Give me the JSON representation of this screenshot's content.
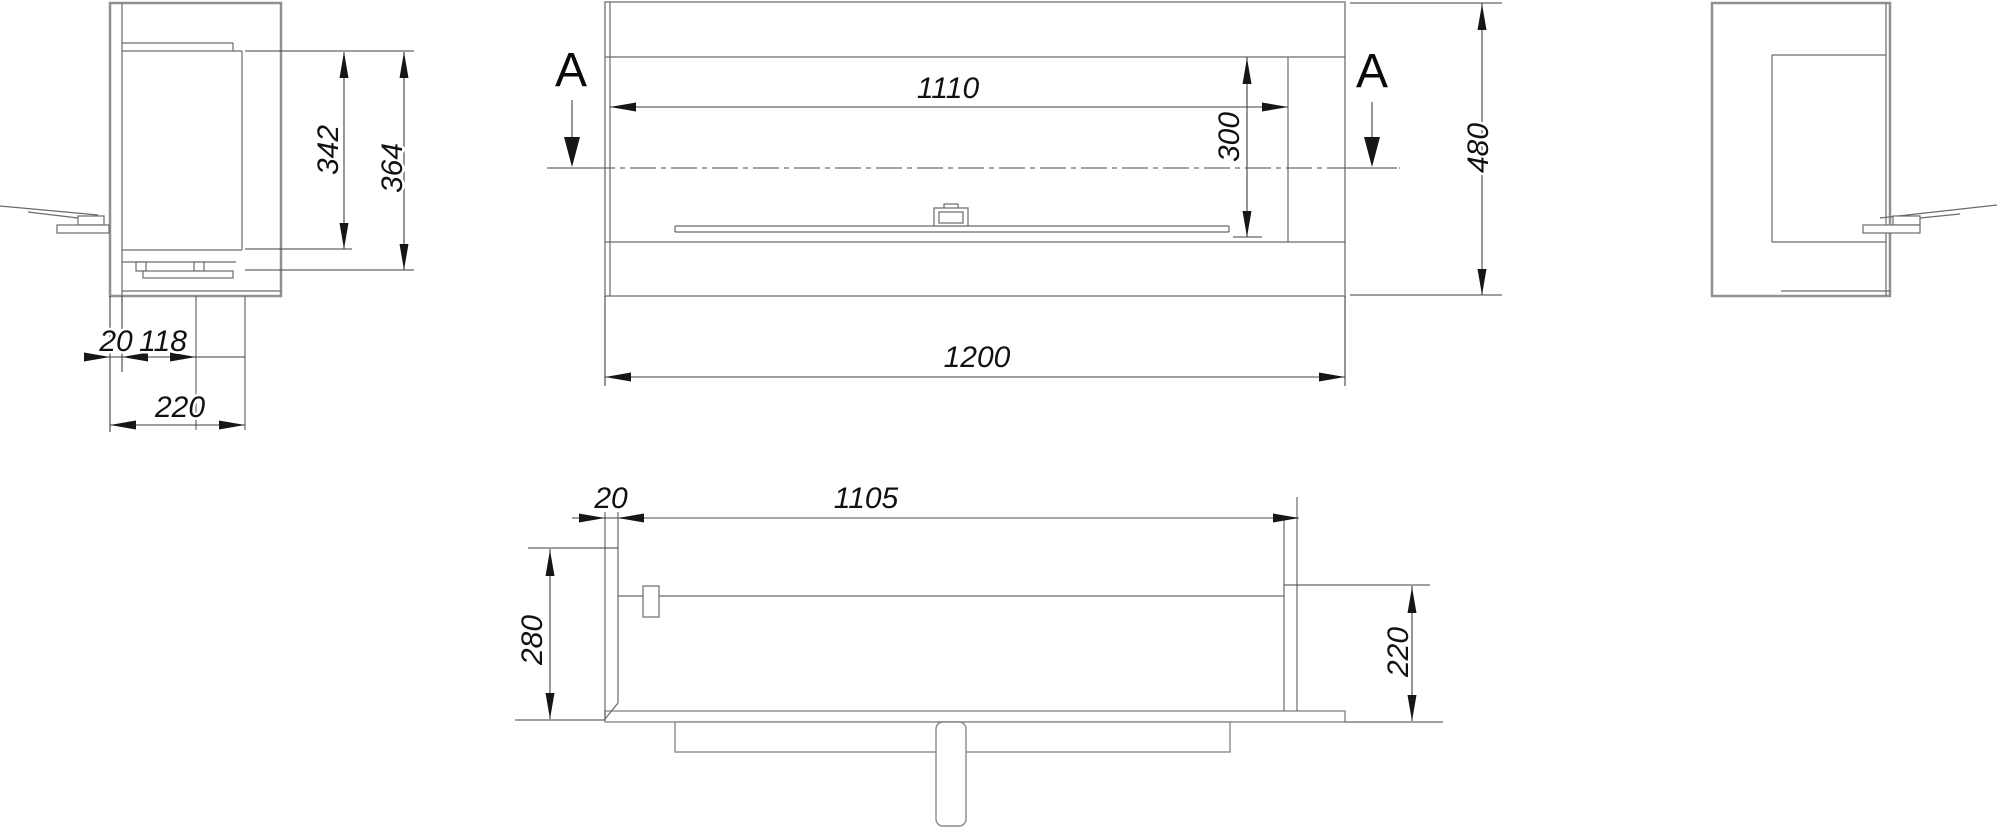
{
  "drawing": {
    "type": "technical dimension drawing of a built-in bio-fireplace insert",
    "views": {
      "side_left": {
        "dim_glass_height": "342",
        "dim_total_height": "364",
        "dim_wall_thickness": "20",
        "dim_inner_depth": "118",
        "dim_base_depth": "220"
      },
      "front": {
        "section_label_left": "A",
        "section_label_right": "A",
        "dim_opening_width": "1110",
        "dim_opening_height": "300",
        "dim_total_width": "1200",
        "dim_total_height": "480"
      },
      "top": {
        "dim_wall_thickness": "20",
        "dim_inner_width": "1105",
        "dim_total_depth": "280",
        "dim_base_depth": "220"
      }
    },
    "colors": {
      "background": "#ffffff",
      "body_edge": "#909090",
      "detail_line": "#6a6a6a",
      "dimension_line": "#3f3f3f",
      "text": "#111111"
    }
  }
}
